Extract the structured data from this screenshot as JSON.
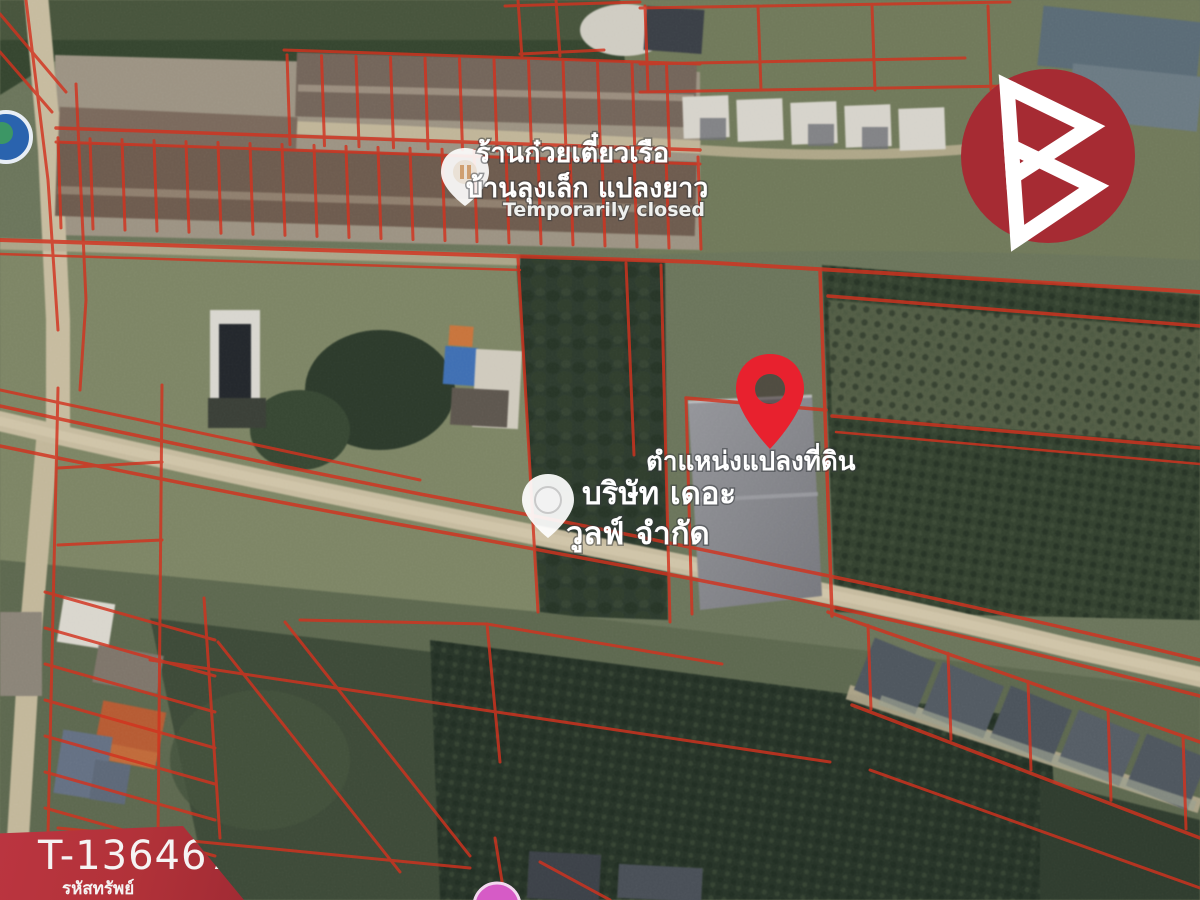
{
  "map_labels": {
    "restaurant": {
      "line1": "ร้านก๋วยเตี๋ยวเรือ",
      "line2": "บ้านลุงเล็ก แปลงยาว",
      "status": "Temporarily closed"
    },
    "parcel_location": "ตำแหน่งแปลงที่ดิน",
    "company": {
      "line1": "บริษัท เดอะ",
      "line2": "วูลฟ์ จำกัด"
    }
  },
  "property_badge": {
    "code": "T-136467",
    "caption": "รหัสทรัพย์"
  },
  "colors": {
    "cadastral_line": "#d2331f",
    "pin": "#e8212e",
    "badge_red": "#b23239",
    "logo_circle": "#a62b33",
    "road": "#c6bb9f"
  }
}
